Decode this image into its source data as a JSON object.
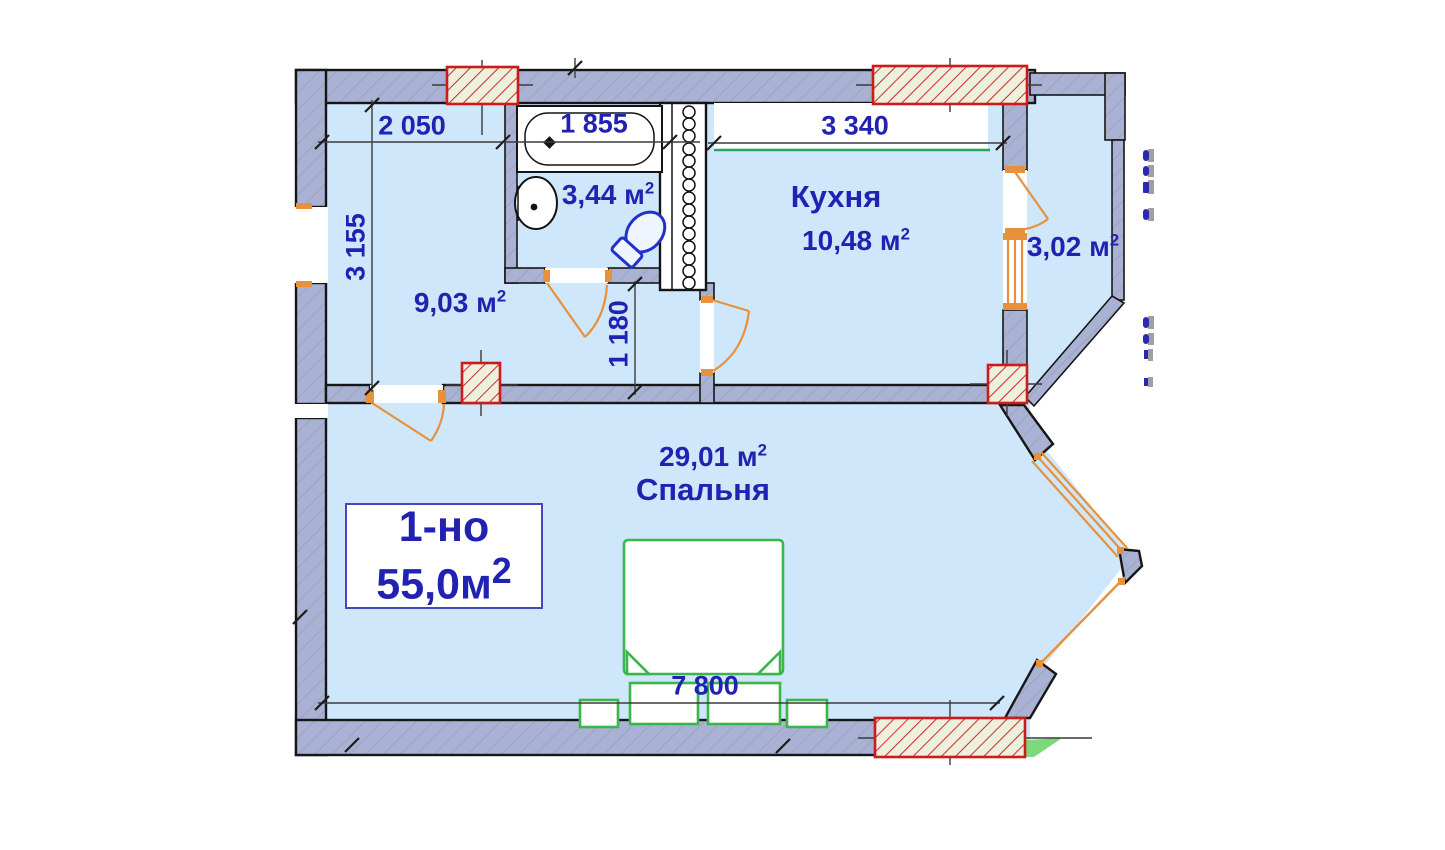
{
  "title_box": {
    "type": "1-но",
    "area": "55,0м",
    "sup": "2"
  },
  "rooms": {
    "hallway": {
      "area": "9,03 м",
      "sup": "2"
    },
    "bathroom": {
      "area": "3,44 м",
      "sup": "2"
    },
    "kitchen": {
      "name": "Кухня",
      "area": "10,48 м",
      "sup": "2"
    },
    "bedroom": {
      "name": "Спальня",
      "area": "29,01 м",
      "sup": "2"
    },
    "balcony": {
      "area": "3,02 м",
      "sup": "2"
    }
  },
  "dimensions": {
    "hallway_width": "2 050",
    "bathtub_length": "1 855",
    "kitchen_width": "3 340",
    "hallway_depth": "3 155",
    "corridor_width": "1 180",
    "apartment_width": "7 800"
  },
  "colors": {
    "ink": "#2121b2",
    "room": "#cfe7fb",
    "wall": "#a9b2d4",
    "red": "#cd1a1a",
    "orange": "#e8913c",
    "green": "#3cb54a",
    "sill": "#2aa35e"
  }
}
